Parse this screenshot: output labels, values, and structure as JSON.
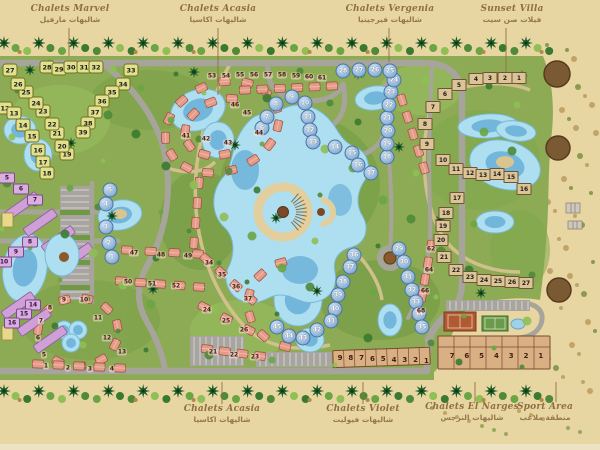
{
  "labels": {
    "top": [
      {
        "en": "Chalets Marvel",
        "ar": "شاليهات مارفيل",
        "x": 70,
        "lx": 69,
        "ly1": 28,
        "ly2": 56
      },
      {
        "en": "Chalets Acasia",
        "ar": "شاليهات اكاسيا",
        "x": 218,
        "lx": 218,
        "ly1": 28,
        "ly2": 95
      },
      {
        "en": "Chalets Vergenia",
        "ar": "شاليهات فيرجينيا",
        "x": 390,
        "lx": 389,
        "ly1": 28,
        "ly2": 62
      },
      {
        "en": "Sunset Villa",
        "ar": "فيلات صن سيت",
        "x": 512,
        "lx": 506,
        "ly1": 28,
        "ly2": 72
      }
    ],
    "bottom": [
      {
        "en": "Chalets Acasia",
        "ar": "شاليهات اكاسيا",
        "x": 222,
        "lx": 222,
        "ly1": 382,
        "ly2": 404
      },
      {
        "en": "Chalets Violet",
        "ar": "شاليهات فيوليت",
        "x": 363,
        "lx": 363,
        "ly1": 382,
        "ly2": 404
      },
      {
        "en": "Chalets El Narges",
        "ar": "شاليهات النرجس",
        "x": 472,
        "lx": 475,
        "ly1": 382,
        "ly2": 402
      },
      {
        "en": "Sport Area",
        "ar": "منطقة ملاعب",
        "x": 545,
        "lx": 556,
        "ly1": 382,
        "ly2": 402
      }
    ]
  },
  "markers": {
    "yellow_plots": [
      {
        "n": "12",
        "x": 5,
        "y": 108
      },
      {
        "n": "13",
        "x": 14,
        "y": 113
      },
      {
        "n": "14",
        "x": 23,
        "y": 125
      },
      {
        "n": "15",
        "x": 32,
        "y": 136
      },
      {
        "n": "16",
        "x": 38,
        "y": 150
      },
      {
        "n": "17",
        "x": 43,
        "y": 162
      },
      {
        "n": "18",
        "x": 47,
        "y": 173
      },
      {
        "n": "19",
        "x": 67,
        "y": 154
      },
      {
        "n": "20",
        "x": 62,
        "y": 146
      },
      {
        "n": "21",
        "x": 57,
        "y": 133
      },
      {
        "n": "22",
        "x": 52,
        "y": 124
      },
      {
        "n": "23",
        "x": 43,
        "y": 111
      },
      {
        "n": "24",
        "x": 36,
        "y": 103
      },
      {
        "n": "25",
        "x": 26,
        "y": 92
      },
      {
        "n": "26",
        "x": 18,
        "y": 84
      },
      {
        "n": "27",
        "x": 10,
        "y": 70
      },
      {
        "n": "28",
        "x": 47,
        "y": 67
      },
      {
        "n": "29",
        "x": 59,
        "y": 69
      },
      {
        "n": "30",
        "x": 71,
        "y": 67
      },
      {
        "n": "31",
        "x": 84,
        "y": 67
      },
      {
        "n": "32",
        "x": 96,
        "y": 67
      },
      {
        "n": "33",
        "x": 131,
        "y": 70
      },
      {
        "n": "34",
        "x": 123,
        "y": 84
      },
      {
        "n": "35",
        "x": 112,
        "y": 92
      },
      {
        "n": "36",
        "x": 102,
        "y": 101
      },
      {
        "n": "37",
        "x": 95,
        "y": 112
      },
      {
        "n": "38",
        "x": 88,
        "y": 123
      },
      {
        "n": "39",
        "x": 83,
        "y": 132
      }
    ],
    "blue_chalets": [
      {
        "n": "1",
        "x": 112,
        "y": 257
      },
      {
        "n": "2",
        "x": 109,
        "y": 243
      },
      {
        "n": "3",
        "x": 106,
        "y": 227
      },
      {
        "n": "4",
        "x": 106,
        "y": 204
      },
      {
        "n": "5",
        "x": 110,
        "y": 190
      },
      {
        "n": "6",
        "x": 262,
        "y": 128
      },
      {
        "n": "7",
        "x": 267,
        "y": 117
      },
      {
        "n": "8",
        "x": 276,
        "y": 104
      },
      {
        "n": "9",
        "x": 292,
        "y": 97
      },
      {
        "n": "10",
        "x": 305,
        "y": 103
      },
      {
        "n": "11",
        "x": 308,
        "y": 117
      },
      {
        "n": "12",
        "x": 310,
        "y": 130
      },
      {
        "n": "13",
        "x": 313,
        "y": 142
      },
      {
        "n": "14",
        "x": 335,
        "y": 147
      },
      {
        "n": "15",
        "x": 352,
        "y": 153
      },
      {
        "n": "16",
        "x": 358,
        "y": 165
      },
      {
        "n": "17",
        "x": 371,
        "y": 173
      },
      {
        "n": "18",
        "x": 387,
        "y": 157
      },
      {
        "n": "19",
        "x": 387,
        "y": 144
      },
      {
        "n": "20",
        "x": 388,
        "y": 131
      },
      {
        "n": "21",
        "x": 387,
        "y": 118
      },
      {
        "n": "22",
        "x": 389,
        "y": 105
      },
      {
        "n": "23",
        "x": 391,
        "y": 92
      },
      {
        "n": "24",
        "x": 394,
        "y": 80
      },
      {
        "n": "25",
        "x": 390,
        "y": 71
      },
      {
        "n": "26",
        "x": 375,
        "y": 70
      },
      {
        "n": "27",
        "x": 359,
        "y": 70
      },
      {
        "n": "28",
        "x": 343,
        "y": 71
      },
      {
        "n": "29",
        "x": 399,
        "y": 249
      },
      {
        "n": "30",
        "x": 404,
        "y": 262
      },
      {
        "n": "31",
        "x": 408,
        "y": 277
      },
      {
        "n": "32",
        "x": 412,
        "y": 290
      },
      {
        "n": "33",
        "x": 416,
        "y": 302
      },
      {
        "n": "34",
        "x": 419,
        "y": 314
      },
      {
        "n": "35",
        "x": 422,
        "y": 327
      },
      {
        "n": "36",
        "x": 354,
        "y": 255
      },
      {
        "n": "37",
        "x": 350,
        "y": 267
      },
      {
        "n": "38",
        "x": 343,
        "y": 282
      },
      {
        "n": "39",
        "x": 338,
        "y": 295
      },
      {
        "n": "40",
        "x": 335,
        "y": 309
      },
      {
        "n": "41",
        "x": 331,
        "y": 321
      },
      {
        "n": "42",
        "x": 317,
        "y": 330
      },
      {
        "n": "43",
        "x": 303,
        "y": 338
      },
      {
        "n": "44",
        "x": 289,
        "y": 336
      },
      {
        "n": "45",
        "x": 277,
        "y": 327
      }
    ],
    "sunset_villas": [
      {
        "n": "1",
        "x": 519,
        "y": 78
      },
      {
        "n": "2",
        "x": 505,
        "y": 78
      },
      {
        "n": "3",
        "x": 490,
        "y": 78
      },
      {
        "n": "4",
        "x": 476,
        "y": 79
      },
      {
        "n": "5",
        "x": 459,
        "y": 85
      },
      {
        "n": "6",
        "x": 445,
        "y": 94
      },
      {
        "n": "7",
        "x": 433,
        "y": 107
      },
      {
        "n": "8",
        "x": 425,
        "y": 124
      },
      {
        "n": "9",
        "x": 427,
        "y": 144
      },
      {
        "n": "10",
        "x": 443,
        "y": 160
      },
      {
        "n": "11",
        "x": 456,
        "y": 169
      },
      {
        "n": "12",
        "x": 470,
        "y": 173
      },
      {
        "n": "13",
        "x": 483,
        "y": 175
      },
      {
        "n": "14",
        "x": 497,
        "y": 174
      },
      {
        "n": "15",
        "x": 511,
        "y": 177
      },
      {
        "n": "16",
        "x": 524,
        "y": 189
      },
      {
        "n": "17",
        "x": 457,
        "y": 198
      }
    ],
    "narges_villas": [
      {
        "n": "18",
        "x": 446,
        "y": 213
      },
      {
        "n": "19",
        "x": 443,
        "y": 226
      },
      {
        "n": "20",
        "x": 441,
        "y": 240
      },
      {
        "n": "21",
        "x": 444,
        "y": 257
      },
      {
        "n": "22",
        "x": 456,
        "y": 270
      },
      {
        "n": "23",
        "x": 470,
        "y": 277
      },
      {
        "n": "24",
        "x": 484,
        "y": 280
      },
      {
        "n": "25",
        "x": 498,
        "y": 281
      },
      {
        "n": "26",
        "x": 512,
        "y": 282
      },
      {
        "n": "27",
        "x": 526,
        "y": 283
      }
    ],
    "purple_buildings": [
      {
        "n": "5",
        "x": 7,
        "y": 178
      },
      {
        "n": "6",
        "x": 21,
        "y": 189
      },
      {
        "n": "7",
        "x": 35,
        "y": 200
      },
      {
        "n": "8",
        "x": 30,
        "y": 242
      },
      {
        "n": "9",
        "x": 16,
        "y": 252
      },
      {
        "n": "10",
        "x": 4,
        "y": 262
      },
      {
        "n": "14",
        "x": 33,
        "y": 305
      },
      {
        "n": "15",
        "x": 24,
        "y": 314
      },
      {
        "n": "16",
        "x": 12,
        "y": 323
      }
    ],
    "salmon_chalets": [
      {
        "n": "53",
        "x": 212,
        "y": 76
      },
      {
        "n": "54",
        "x": 226,
        "y": 76
      },
      {
        "n": "55",
        "x": 240,
        "y": 75
      },
      {
        "n": "56",
        "x": 254,
        "y": 75
      },
      {
        "n": "57",
        "x": 268,
        "y": 75
      },
      {
        "n": "58",
        "x": 282,
        "y": 75
      },
      {
        "n": "59",
        "x": 296,
        "y": 76
      },
      {
        "n": "60",
        "x": 309,
        "y": 77
      },
      {
        "n": "61",
        "x": 322,
        "y": 78
      },
      {
        "n": "41",
        "x": 186,
        "y": 136
      },
      {
        "n": "42",
        "x": 206,
        "y": 139
      },
      {
        "n": "43",
        "x": 228,
        "y": 143
      },
      {
        "n": "44",
        "x": 259,
        "y": 133
      },
      {
        "n": "45",
        "x": 247,
        "y": 113
      },
      {
        "n": "46",
        "x": 235,
        "y": 105
      },
      {
        "n": "47",
        "x": 134,
        "y": 253
      },
      {
        "n": "48",
        "x": 161,
        "y": 255
      },
      {
        "n": "49",
        "x": 188,
        "y": 256
      },
      {
        "n": "50",
        "x": 128,
        "y": 282
      },
      {
        "n": "51",
        "x": 152,
        "y": 284
      },
      {
        "n": "52",
        "x": 176,
        "y": 286
      },
      {
        "n": "34",
        "x": 209,
        "y": 263
      },
      {
        "n": "35",
        "x": 222,
        "y": 275
      },
      {
        "n": "36",
        "x": 236,
        "y": 287
      },
      {
        "n": "37",
        "x": 248,
        "y": 299
      },
      {
        "n": "24",
        "x": 207,
        "y": 310
      },
      {
        "n": "25",
        "x": 226,
        "y": 321
      },
      {
        "n": "26",
        "x": 244,
        "y": 330
      },
      {
        "n": "21",
        "x": 213,
        "y": 352
      },
      {
        "n": "22",
        "x": 234,
        "y": 355
      },
      {
        "n": "23",
        "x": 255,
        "y": 357
      },
      {
        "n": "5",
        "x": 44,
        "y": 355
      },
      {
        "n": "6",
        "x": 38,
        "y": 338
      },
      {
        "n": "7",
        "x": 41,
        "y": 321
      },
      {
        "n": "8",
        "x": 50,
        "y": 308
      },
      {
        "n": "9",
        "x": 64,
        "y": 300
      },
      {
        "n": "10",
        "x": 84,
        "y": 300
      },
      {
        "n": "11",
        "x": 98,
        "y": 318
      },
      {
        "n": "12",
        "x": 107,
        "y": 338
      },
      {
        "n": "13",
        "x": 122,
        "y": 352
      },
      {
        "n": "1",
        "x": 46,
        "y": 366
      },
      {
        "n": "2",
        "x": 68,
        "y": 368
      },
      {
        "n": "3",
        "x": 90,
        "y": 369
      },
      {
        "n": "4",
        "x": 112,
        "y": 369
      },
      {
        "n": "62",
        "x": 431,
        "y": 249
      },
      {
        "n": "64",
        "x": 429,
        "y": 270
      },
      {
        "n": "66",
        "x": 425,
        "y": 291
      },
      {
        "n": "68",
        "x": 421,
        "y": 311
      }
    ],
    "shop_row_left": [
      "9",
      "8",
      "7",
      "6",
      "5",
      "4",
      "3",
      "2",
      "1"
    ],
    "shop_row_right": [
      "7",
      "6",
      "5",
      "4",
      "3",
      "2",
      "1"
    ]
  },
  "colors": {
    "sand": "#e8d6a2",
    "green": "#8cab54",
    "road": "#a7a49b",
    "pool_light": "#aedff0",
    "pool_deep": "#5fa8d4",
    "salmon": "#e59b88",
    "yellow_plot": "#e0e08f",
    "blue_dome": "#8fb4da",
    "purple": "#d9aee1",
    "villa_tan": "#dcc497",
    "shop_tan": "#d8b084",
    "label_brown": "#8f6f42"
  }
}
